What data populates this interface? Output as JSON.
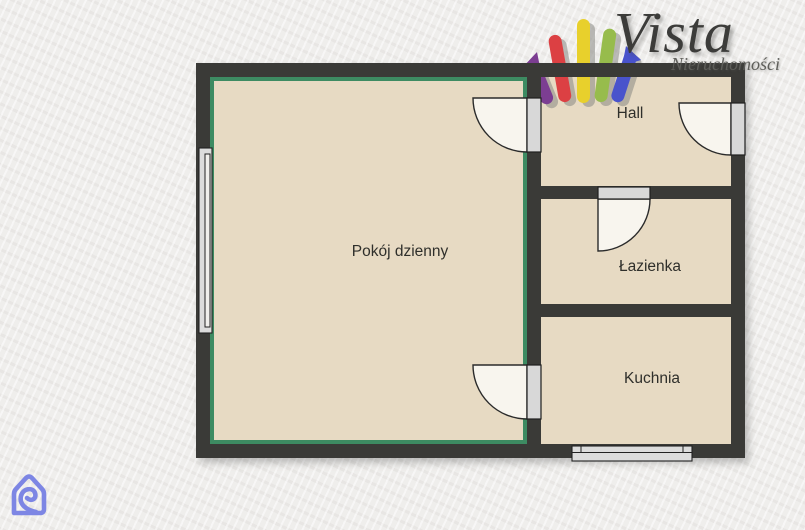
{
  "logo": {
    "brand": "Vista",
    "subtitle": "Nieruchomości",
    "mark_colors": [
      "#7c3e92",
      "#dc4043",
      "#e8d02c",
      "#97bc4c",
      "#4953cc"
    ],
    "text_color": "#3c3c3a"
  },
  "plan": {
    "rooms": [
      {
        "id": "pokoj-dzienny",
        "label": "Pokój dzienny",
        "highlighted": true
      },
      {
        "id": "hall",
        "label": "Hall",
        "highlighted": false
      },
      {
        "id": "lazienka",
        "label": "Łazienka",
        "highlighted": false
      },
      {
        "id": "kuchnia",
        "label": "Kuchnia",
        "highlighted": false
      }
    ]
  },
  "colors": {
    "background": "#efeeec",
    "wall": "#3a3a37",
    "room_fill": "#e7dac3",
    "highlight_green": "#3d8b62",
    "door_fill": "#f8f5ee",
    "window_gray": "#dcdcdc",
    "portal_icon_blue": "#7d86e4"
  }
}
